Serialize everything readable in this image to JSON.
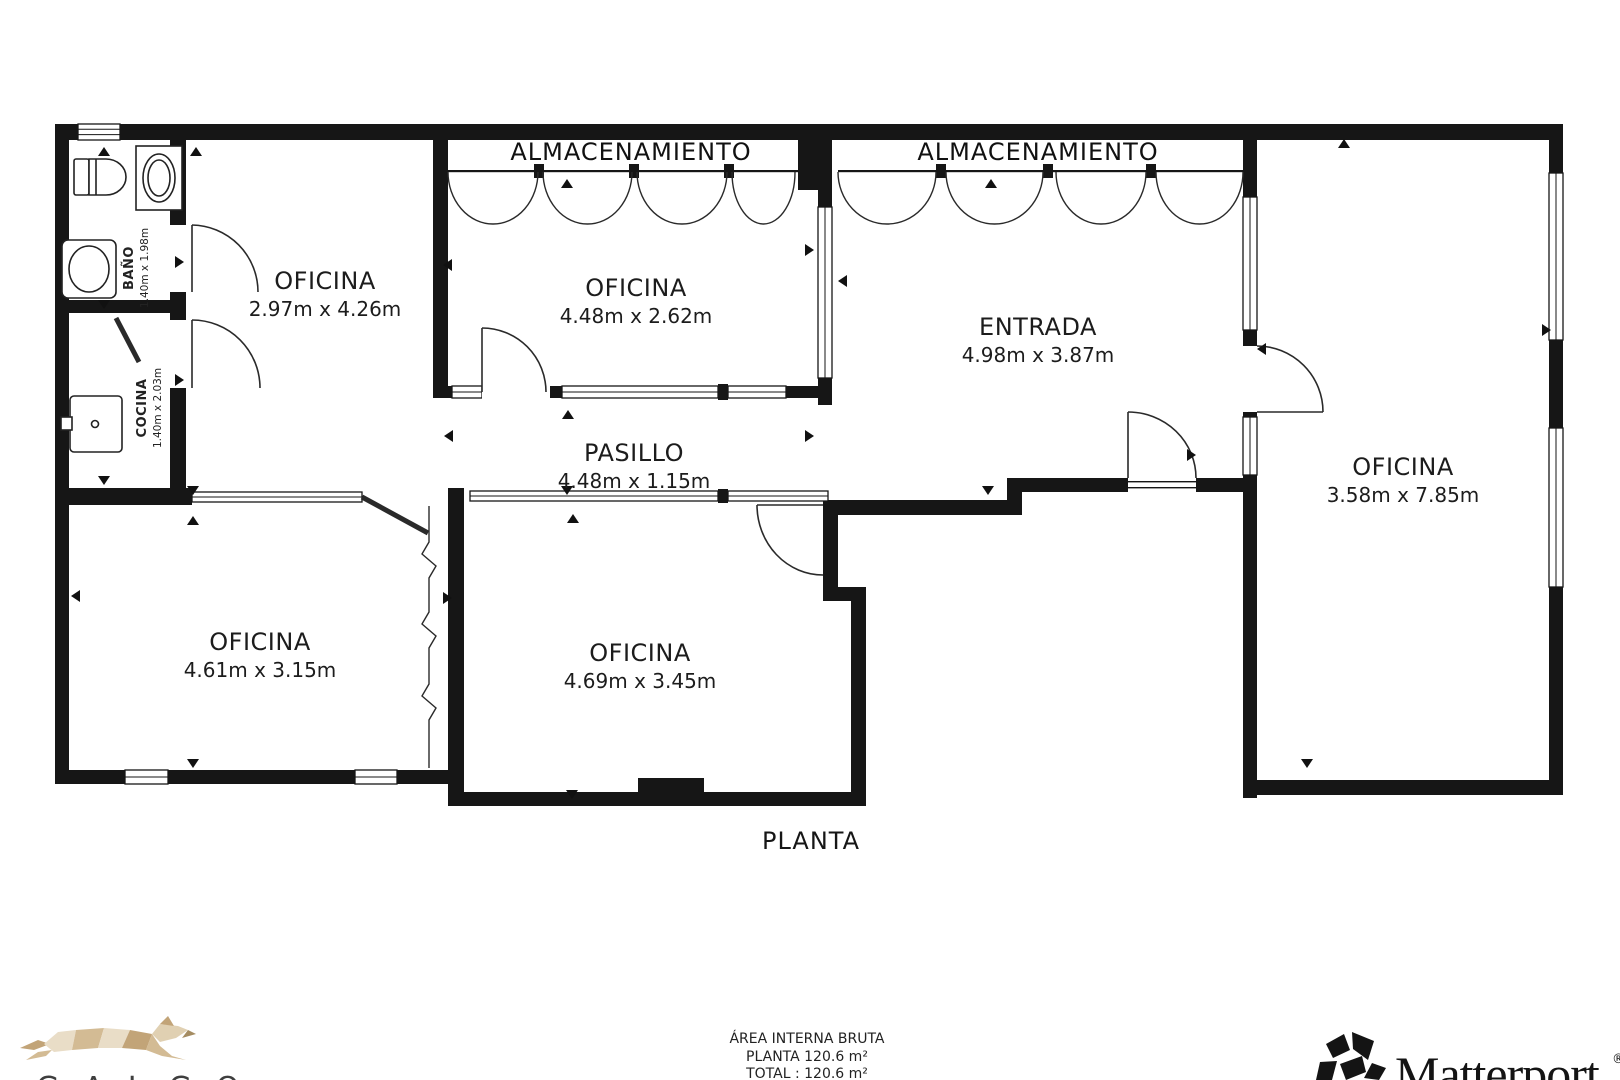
{
  "colors": {
    "wall": "#161616",
    "line": "#222222",
    "logo_tan_light": "#e9ddc7",
    "logo_tan_mid": "#d3bb94",
    "logo_tan_dark": "#c2a478",
    "galgo_text": "#3f3f3f"
  },
  "plan": {
    "title": "PLANTA",
    "storage_label_1": "ALMACENAMIENTO",
    "storage_label_2": "ALMACENAMIENTO",
    "rooms": [
      {
        "id": "oficina-left",
        "label": "OFICINA",
        "dims": "2.97m x 4.26m"
      },
      {
        "id": "oficina-top",
        "label": "OFICINA",
        "dims": "4.48m x 2.62m"
      },
      {
        "id": "entrada",
        "label": "ENTRADA",
        "dims": "4.98m x 3.87m"
      },
      {
        "id": "oficina-right",
        "label": "OFICINA",
        "dims": "3.58m x 7.85m"
      },
      {
        "id": "pasillo",
        "label": "PASILLO",
        "dims": "4.48m x 1.15m"
      },
      {
        "id": "oficina-bottom-left",
        "label": "OFICINA",
        "dims": "4.61m x 3.15m"
      },
      {
        "id": "oficina-bottom-mid",
        "label": "OFICINA",
        "dims": "4.69m x 3.45m"
      },
      {
        "id": "bano",
        "label": "BAÑO",
        "dims": "1.40m x 1.98m"
      },
      {
        "id": "cocina",
        "label": "COCINA",
        "dims": "1.40m x 2.03m"
      }
    ]
  },
  "summary": {
    "heading": "ÁREA INTERNA BRUTA",
    "planta_area": "PLANTA 120.6 m²",
    "total_area": "TOTAL :  120.6 m²"
  },
  "branding": {
    "agency_name": "GALGO",
    "matterport_wordmark": "Matterport",
    "registered_mark": "®"
  }
}
